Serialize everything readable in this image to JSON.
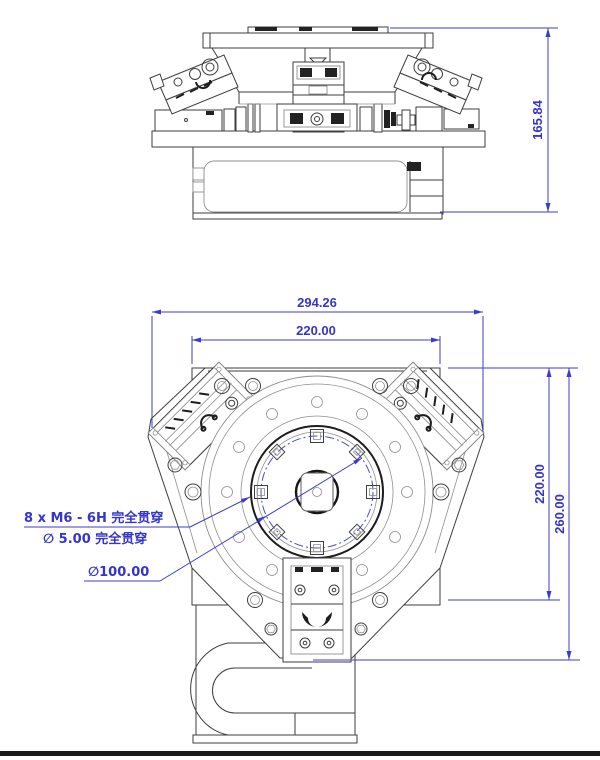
{
  "drawing": {
    "title_hint": "rotary-stage-engineering-drawing",
    "side_view": {
      "height_dim": "165.84"
    },
    "plan_view": {
      "outer_width_dim": "294.26",
      "inner_width_dim": "220.00",
      "inner_height_dim": "220.00",
      "outer_height_dim": "260.00",
      "thread_note": "8 x M6 - 6H 完全贯穿",
      "hole_note": "∅ 5.00 完全贯穿",
      "bolt_circle_note": "∅100.00"
    },
    "colors": {
      "dimension_blue": "#3b3bd2",
      "line_dark": "#3e3e3e",
      "line_light": "#8f8f8f",
      "feature_black": "#222222",
      "background": "#ffffff"
    }
  }
}
